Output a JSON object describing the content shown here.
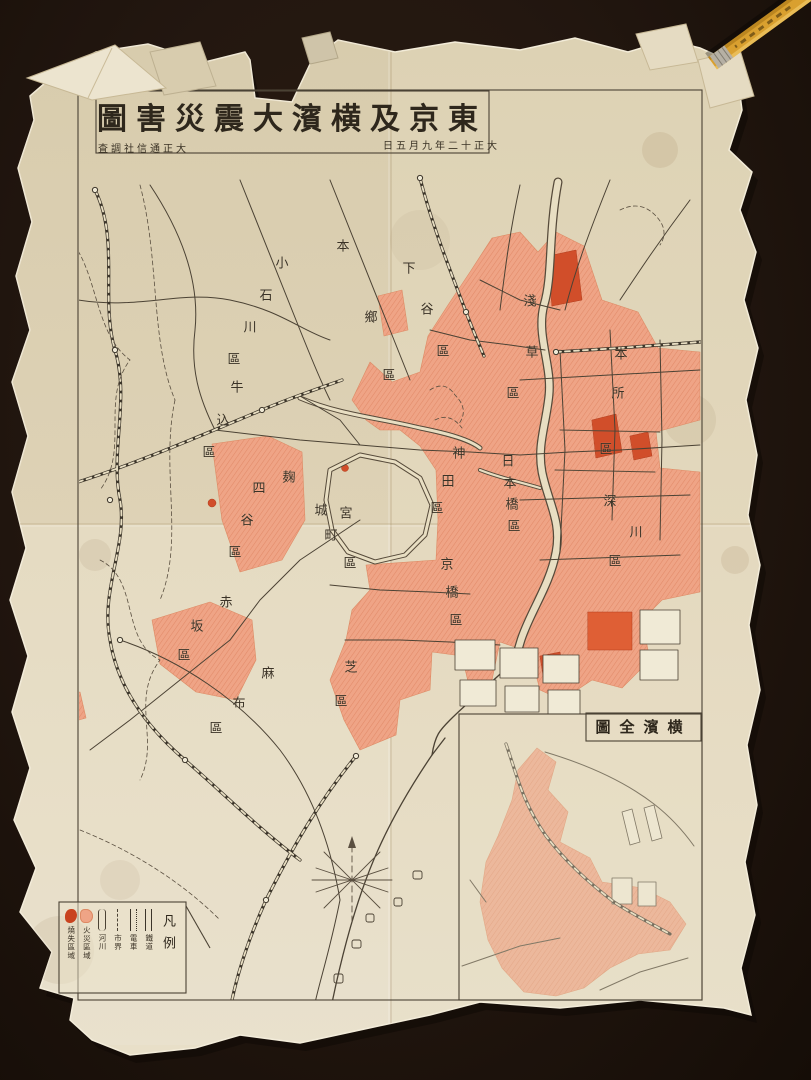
{
  "map": {
    "title": "東京及横濱大震災害圖",
    "date": "大正十二年九月五日",
    "credit": "大正通信社調査",
    "inset_title": "横濱全圖",
    "legend": {
      "title": "凡例",
      "items": [
        {
          "icon": "rail-icon",
          "label": "鐵道"
        },
        {
          "icon": "tram-icon",
          "label": "電車"
        },
        {
          "icon": "boundary-icon",
          "label": "市界"
        },
        {
          "icon": "river-icon",
          "label": "河川"
        },
        {
          "icon": "burnt-hatched-icon",
          "label": "火災區域"
        },
        {
          "icon": "burnt-solid-icon",
          "label": "燒失區域"
        }
      ]
    },
    "wards": [
      {
        "name": "小石川區",
        "chars": [
          [
            "小",
            282,
            262
          ],
          [
            "石",
            266,
            294
          ],
          [
            "川",
            250,
            326
          ],
          [
            "區",
            234,
            358
          ]
        ]
      },
      {
        "name": "本鄉區",
        "chars": [
          [
            "本",
            343,
            245
          ],
          [
            "鄉",
            371,
            316
          ],
          [
            "區",
            389,
            374
          ]
        ]
      },
      {
        "name": "下谷區",
        "chars": [
          [
            "下",
            409,
            267
          ],
          [
            "谷",
            427,
            308
          ],
          [
            "區",
            443,
            350
          ]
        ]
      },
      {
        "name": "牛込區",
        "chars": [
          [
            "牛",
            237,
            386
          ],
          [
            "込",
            223,
            419
          ],
          [
            "區",
            209,
            451
          ]
        ]
      },
      {
        "name": "四谷區",
        "chars": [
          [
            "四",
            259,
            487
          ],
          [
            "谷",
            247,
            519
          ],
          [
            "區",
            235,
            551
          ]
        ]
      },
      {
        "name": "麹町區",
        "chars": [
          [
            "麹",
            289,
            476
          ],
          [
            "町",
            331,
            534
          ],
          [
            "區",
            350,
            562
          ]
        ]
      },
      {
        "name": "宮城",
        "chars": [
          [
            "宮",
            346,
            512
          ],
          [
            "城",
            321,
            509
          ]
        ]
      },
      {
        "name": "赤坂區",
        "chars": [
          [
            "赤",
            226,
            601
          ],
          [
            "坂",
            197,
            625
          ],
          [
            "區",
            184,
            654
          ]
        ]
      },
      {
        "name": "麻布區",
        "chars": [
          [
            "麻",
            268,
            672
          ],
          [
            "布",
            239,
            702
          ],
          [
            "區",
            216,
            727
          ]
        ]
      },
      {
        "name": "芝區",
        "chars": [
          [
            "芝",
            351,
            666
          ],
          [
            "區",
            341,
            700
          ]
        ]
      },
      {
        "name": "神田區",
        "chars": [
          [
            "神",
            459,
            452
          ],
          [
            "田",
            448,
            480
          ],
          [
            "區",
            437,
            507
          ]
        ]
      },
      {
        "name": "日本橋區",
        "chars": [
          [
            "日",
            508,
            460
          ],
          [
            "本",
            510,
            482
          ],
          [
            "橋",
            512,
            503
          ],
          [
            "區",
            514,
            525
          ]
        ]
      },
      {
        "name": "京橋區",
        "chars": [
          [
            "京",
            447,
            563
          ],
          [
            "橋",
            452,
            591
          ],
          [
            "區",
            456,
            619
          ]
        ]
      },
      {
        "name": "淺草區",
        "chars": [
          [
            "淺",
            530,
            300
          ],
          [
            "草",
            532,
            351
          ],
          [
            "區",
            513,
            392
          ]
        ]
      },
      {
        "name": "本所區",
        "chars": [
          [
            "本",
            621,
            353
          ],
          [
            "所",
            618,
            392
          ],
          [
            "區",
            606,
            448
          ]
        ]
      },
      {
        "name": "深川區",
        "chars": [
          [
            "深",
            610,
            500
          ],
          [
            "川",
            636,
            531
          ],
          [
            "區",
            615,
            560
          ]
        ]
      }
    ],
    "colors": {
      "background": "#231710",
      "paper": "#e3d8bd",
      "burnt_area": "#efa486",
      "burnt_severe": "#d14e2a",
      "ink": "#4b4234",
      "pencil": "#d9a02f"
    }
  }
}
